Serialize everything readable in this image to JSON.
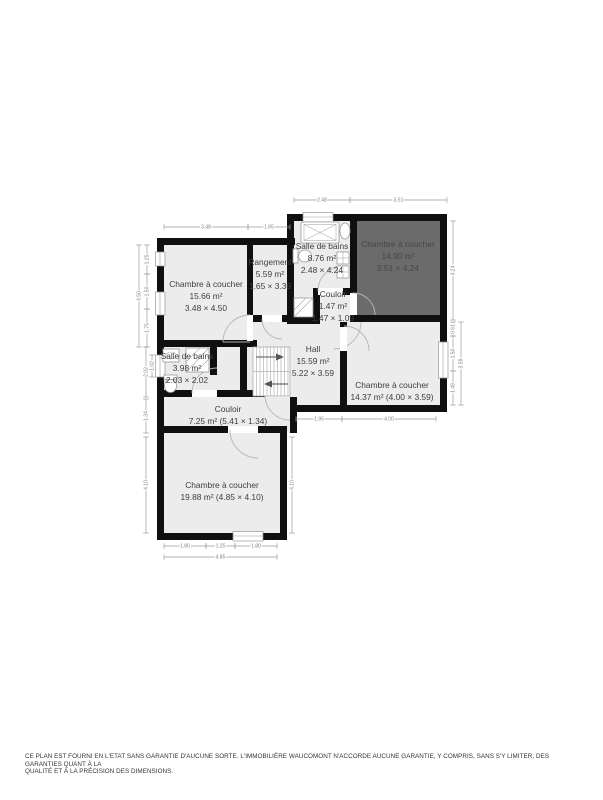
{
  "colors": {
    "wall": "#101010",
    "room": "#ececec",
    "dark": "#6b6b6b",
    "darktext": "#474747",
    "labelc": "#3e3e3e",
    "dimc": "#9a9a9a"
  },
  "rooms": [
    {
      "id": "chambre-15-66",
      "cx": 206,
      "y": 287,
      "dark": false,
      "lines": [
        "Chambre à coucher",
        "15.66 m²",
        "3.48 × 4.50"
      ]
    },
    {
      "id": "rangement",
      "cx": 270,
      "y": 265,
      "dark": false,
      "lines": [
        "Rangement",
        "5.59 m²",
        "1.65 × 3.39"
      ]
    },
    {
      "id": "salle-de-bains-8-76",
      "cx": 322,
      "y": 249,
      "dark": false,
      "lines": [
        "Salle de bains",
        "8.76 m²",
        "2.48 × 4.24"
      ]
    },
    {
      "id": "chambre-14-90",
      "cx": 398,
      "y": 247,
      "dark": true,
      "lines": [
        "Chambre à coucher",
        "14.90 m²",
        "3.51 × 4.24"
      ]
    },
    {
      "id": "couloir-1-47",
      "cx": 333,
      "y": 297,
      "dark": false,
      "lines": [
        "Couloir",
        "1.47 m²",
        "1.47 × 1.09"
      ]
    },
    {
      "id": "hall",
      "cx": 313,
      "y": 352,
      "dark": false,
      "lines": [
        "Hall",
        "15.59 m²",
        "5.22 × 3.59"
      ]
    },
    {
      "id": "salle-de-bains-3-98",
      "cx": 187,
      "y": 359,
      "dark": false,
      "lines": [
        "Salle de bains",
        "3.98 m²",
        "2.03 × 2.02"
      ]
    },
    {
      "id": "chambre-14-37",
      "cx": 392,
      "y": 388,
      "dark": false,
      "lines": [
        "Chambre à coucher",
        "14.37 m² (4.00 × 3.59)"
      ]
    },
    {
      "id": "couloir-7-25",
      "cx": 228,
      "y": 412,
      "dark": false,
      "lines": [
        "Couloir",
        "7.25 m² (5.41 × 1.34)"
      ]
    },
    {
      "id": "chambre-19-88",
      "cx": 222,
      "y": 488,
      "dark": false,
      "lines": [
        "Chambre à coucher",
        "19.88 m² (4.85 × 4.10)"
      ]
    }
  ],
  "dims": [
    {
      "o": "h",
      "x1": 294,
      "y1": 200,
      "x2": 350,
      "y2": 200,
      "label": "2.48"
    },
    {
      "o": "h",
      "x1": 350,
      "y1": 200,
      "x2": 447,
      "y2": 200,
      "label": "3.51"
    },
    {
      "o": "h",
      "x1": 164,
      "y1": 227,
      "x2": 248,
      "y2": 227,
      "label": "3.48"
    },
    {
      "o": "h",
      "x1": 248,
      "y1": 227,
      "x2": 290,
      "y2": 227,
      "label": "1.65"
    },
    {
      "o": "v",
      "x1": 147,
      "y1": 245,
      "x2": 147,
      "y2": 274,
      "label": "1.25"
    },
    {
      "o": "v",
      "x1": 147,
      "y1": 274,
      "x2": 147,
      "y2": 309,
      "label": "1.50"
    },
    {
      "o": "v",
      "x1": 147,
      "y1": 309,
      "x2": 147,
      "y2": 347,
      "label": "1.75"
    },
    {
      "o": "v",
      "x1": 139,
      "y1": 245,
      "x2": 139,
      "y2": 347,
      "label": "4.50"
    },
    {
      "o": "v",
      "x1": 152,
      "y1": 355,
      "x2": 152,
      "y2": 377,
      "label": "1.02"
    },
    {
      "o": "v",
      "x1": 146,
      "y1": 347,
      "x2": 146,
      "y2": 397,
      "label": "2.02"
    },
    {
      "o": "v",
      "x1": 146,
      "y1": 399,
      "x2": 146,
      "y2": 433,
      "label": "1.34"
    },
    {
      "o": "v",
      "x1": 146,
      "y1": 437,
      "x2": 146,
      "y2": 533,
      "label": "4.10"
    },
    {
      "o": "v",
      "x1": 453,
      "y1": 221,
      "x2": 453,
      "y2": 320,
      "label": "4.24"
    },
    {
      "o": "v",
      "x1": 453,
      "y1": 322,
      "x2": 453,
      "y2": 336,
      "label": "0.61"
    },
    {
      "o": "v",
      "x1": 453,
      "y1": 336,
      "x2": 453,
      "y2": 371,
      "label": "1.50"
    },
    {
      "o": "v",
      "x1": 453,
      "y1": 371,
      "x2": 453,
      "y2": 405,
      "label": "1.48"
    },
    {
      "o": "v",
      "x1": 461,
      "y1": 322,
      "x2": 461,
      "y2": 405,
      "label": "3.59"
    },
    {
      "o": "h",
      "x1": 296,
      "y1": 419,
      "x2": 342,
      "y2": 419,
      "label": "1.95"
    },
    {
      "o": "h",
      "x1": 342,
      "y1": 419,
      "x2": 436,
      "y2": 419,
      "label": "4.00"
    },
    {
      "o": "h",
      "x1": 164,
      "y1": 546,
      "x2": 206,
      "y2": 546,
      "label": "1.80"
    },
    {
      "o": "h",
      "x1": 206,
      "y1": 546,
      "x2": 235,
      "y2": 546,
      "label": "1.25"
    },
    {
      "o": "h",
      "x1": 235,
      "y1": 546,
      "x2": 277,
      "y2": 546,
      "label": "1.80"
    },
    {
      "o": "h",
      "x1": 164,
      "y1": 557,
      "x2": 277,
      "y2": 557,
      "label": "4.85"
    },
    {
      "o": "v",
      "x1": 292,
      "y1": 437,
      "x2": 292,
      "y2": 533,
      "label": "4.10"
    }
  ],
  "footer": {
    "line1": "CE PLAN EST FOURNI EN L'ETAT SANS GARANTIE D'AUCUNE SORTE. L'IMMOBILIÈRE WAUCOMONT N'ACCORDE AUCUNE GARANTIE, Y COMPRIS, SANS S'Y LIMITER, DES GARANTIES QUANT À LA",
    "line2": "QUALITÉ ET À LA PRÉCISION DES DIMENSIONS."
  }
}
